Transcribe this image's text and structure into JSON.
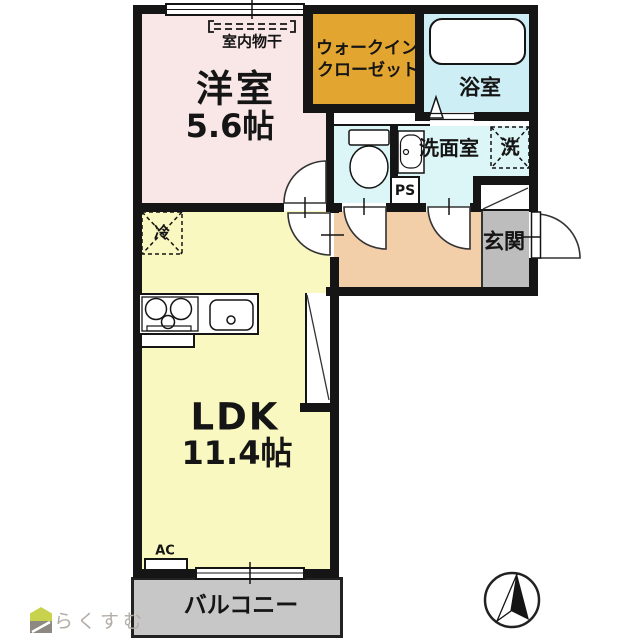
{
  "floorplan": {
    "rooms": {
      "western": {
        "name": "洋室",
        "size": "5.6帖"
      },
      "wic": {
        "name_line1": "ウォークイン",
        "name_line2": "クローゼット"
      },
      "bath": {
        "name": "浴室"
      },
      "washroom": {
        "name": "洗面室"
      },
      "genkan": {
        "name": "玄関"
      },
      "ldk": {
        "name": "LDK",
        "size": "11.4帖"
      },
      "balcony": {
        "name": "バルコニー"
      }
    },
    "fixtures": {
      "laundry_machine": "洗",
      "pipe_space": "PS",
      "refrigerator": "冷",
      "air_conditioner": "AC",
      "indoor_drying": "室内物干"
    },
    "colors": {
      "wall": "#151515",
      "western_room": "#f9e7e7",
      "ldk": "#f9f8c0",
      "wic": "#e2a52f",
      "bath": "#cdeef4",
      "washroom": "#dcf5f7",
      "hallway": "#f2cfa8",
      "genkan": "#bdbdbd",
      "balcony": "#c7c7c7",
      "logo_green": "#c8d24c",
      "logo_gray": "#8d8882"
    },
    "branding": {
      "logo_text": "らくすむ"
    }
  }
}
